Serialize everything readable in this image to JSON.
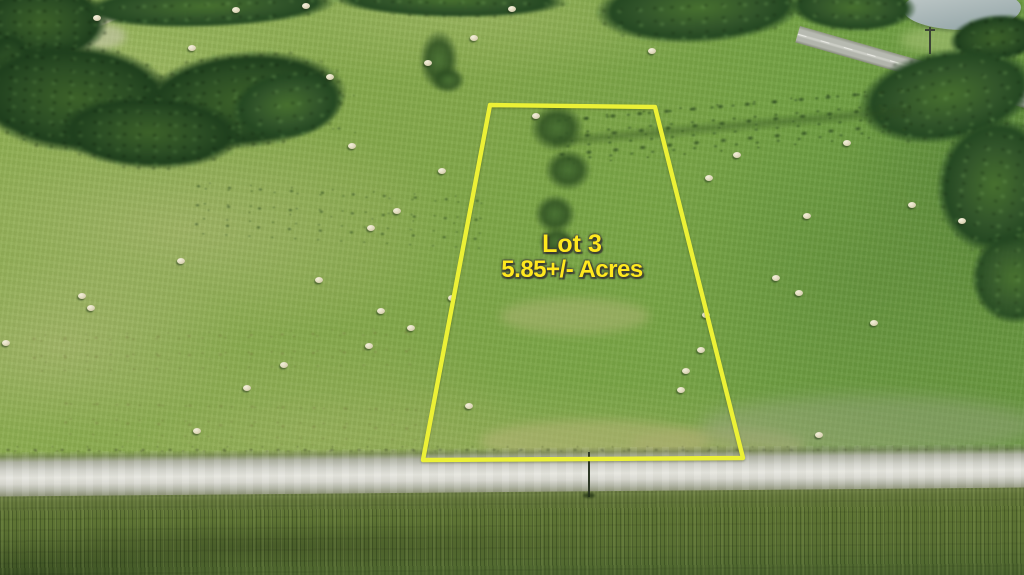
{
  "annotation": {
    "lot_label": "Lot 3",
    "acreage_label": "5.85+/- Acres",
    "boundary_color": "#ecf136",
    "label_color": "#ffe81e",
    "boundary_points": "490,105 655,107 743,458 423,460"
  },
  "scene": {
    "colors": {
      "pasture_green": "#83a74a",
      "tree_green": "#32552a",
      "gravel_road_gray": "#d9d9d1",
      "crop_field_olive": "#5c7233",
      "pond_gray_blue": "#a7b5b6",
      "highway_gray": "#b7bab1",
      "hay_bale_cream": "#e9e4cc",
      "dirt_road_tan": "#d9cfa8"
    },
    "hay_bales": [
      [
        93,
        15
      ],
      [
        232,
        7
      ],
      [
        302,
        3
      ],
      [
        188,
        45
      ],
      [
        326,
        74
      ],
      [
        424,
        60
      ],
      [
        470,
        35
      ],
      [
        508,
        6
      ],
      [
        648,
        48
      ],
      [
        532,
        113
      ],
      [
        348,
        143
      ],
      [
        438,
        168
      ],
      [
        393,
        208
      ],
      [
        367,
        225
      ],
      [
        177,
        258
      ],
      [
        315,
        277
      ],
      [
        448,
        295
      ],
      [
        78,
        293
      ],
      [
        87,
        305
      ],
      [
        2,
        340
      ],
      [
        280,
        362
      ],
      [
        243,
        385
      ],
      [
        193,
        428
      ],
      [
        377,
        308
      ],
      [
        407,
        325
      ],
      [
        365,
        343
      ],
      [
        465,
        403
      ],
      [
        705,
        175
      ],
      [
        733,
        152
      ],
      [
        803,
        213
      ],
      [
        843,
        140
      ],
      [
        908,
        202
      ],
      [
        958,
        218
      ],
      [
        772,
        275
      ],
      [
        795,
        290
      ],
      [
        870,
        320
      ],
      [
        815,
        432
      ],
      [
        702,
        312
      ],
      [
        697,
        347
      ],
      [
        682,
        368
      ],
      [
        677,
        387
      ]
    ]
  }
}
